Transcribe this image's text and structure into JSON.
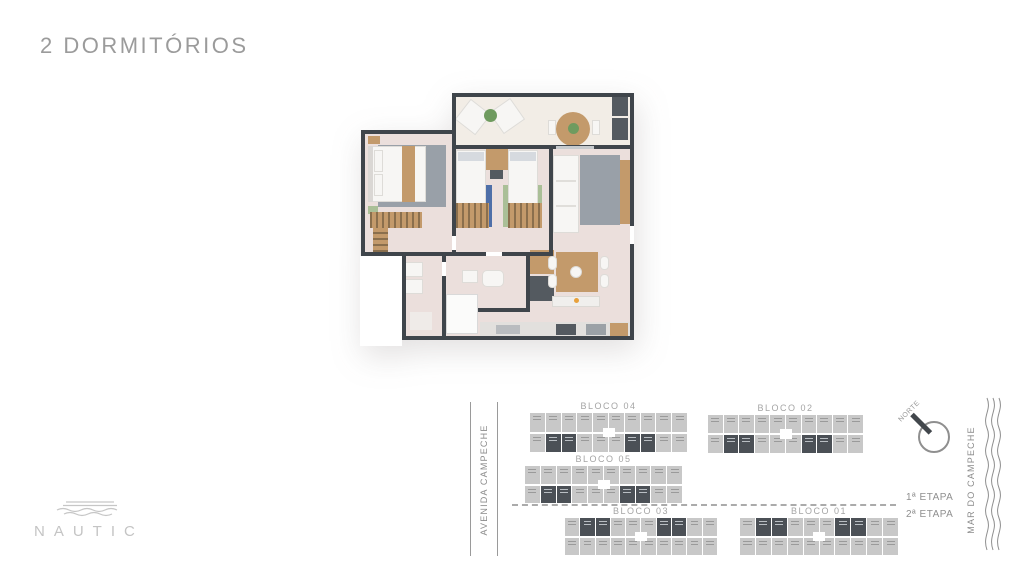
{
  "page": {
    "title": "2 DORMITÓRIOS"
  },
  "logo": {
    "text": "NAUTIC"
  },
  "site_plan": {
    "street_left": "AVENIDA CAMPECHE",
    "street_right": "MAR DO CAMPECHE",
    "compass_label": "NORTE",
    "stage_labels": [
      "1ª ETAPA",
      "2ª ETAPA"
    ],
    "blocks": [
      {
        "label": "BLOCO 04",
        "x": 530,
        "y": 413,
        "w": 157,
        "h": 39,
        "units_per_row": 10,
        "dark_row": "bottom",
        "dark_cols": [
          1,
          2,
          6,
          7
        ]
      },
      {
        "label": "BLOCO 02",
        "x": 708,
        "y": 415,
        "w": 155,
        "h": 38,
        "units_per_row": 10,
        "dark_row": "bottom",
        "dark_cols": [
          1,
          2,
          6,
          7
        ]
      },
      {
        "label": "BLOCO 05",
        "x": 525,
        "y": 466,
        "w": 157,
        "h": 37,
        "units_per_row": 10,
        "dark_row": "bottom",
        "dark_cols": [
          1,
          2,
          6,
          7
        ]
      },
      {
        "label": "BLOCO 03",
        "x": 565,
        "y": 518,
        "w": 152,
        "h": 37,
        "units_per_row": 10,
        "dark_row": "top",
        "dark_cols": [
          1,
          2,
          6,
          7
        ]
      },
      {
        "label": "BLOCO 01",
        "x": 740,
        "y": 518,
        "w": 158,
        "h": 37,
        "units_per_row": 10,
        "dark_row": "top",
        "dark_cols": [
          1,
          2,
          6,
          7
        ]
      }
    ]
  },
  "palette": {
    "wall": "#3F454B",
    "floor": "#EBDFDC",
    "floor_balcony": "#F2EDE6",
    "wood": "#C39A6B",
    "wood_dark": "#8A6F4D",
    "rug_gray": "#99A0A8",
    "rug_blue": "#4E6FA8",
    "rug_green": "#AABF97",
    "dark_furniture": "#545A60",
    "white_furniture": "#F7F6F4",
    "building_gray": "#C8C8C8",
    "building_dark": "#4B5056",
    "text_gray": "#9B9B9B",
    "text_light": "#C4C4C4",
    "accent_orange": "#E8A13C",
    "plant_green": "#6F9B5F"
  }
}
